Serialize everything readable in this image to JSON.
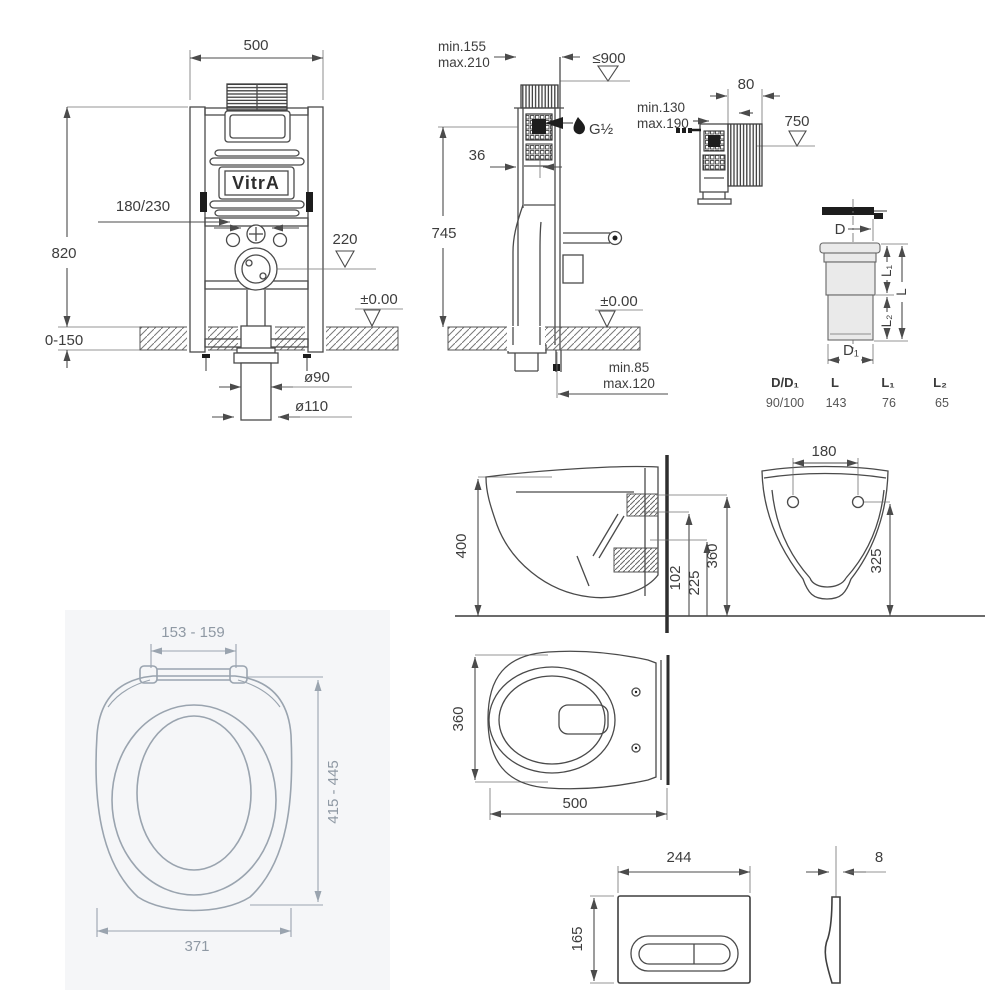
{
  "brand": {
    "logo_text": "VitrA"
  },
  "frame_front": {
    "width": "500",
    "height": "820",
    "floor_adjust": "0-150",
    "flush_pipe": "180/230",
    "drain_depth": "220",
    "datum": "±0.00",
    "dia_90": "ø90",
    "dia_110": "ø110"
  },
  "frame_side": {
    "depth_min": "min.155",
    "depth_max": "max.210",
    "panel_height_max": "≤900",
    "pipe_offset": "36",
    "height": "745",
    "water_connection": "G½",
    "datum": "±0.00",
    "outlet_min": "min.85",
    "outlet_max": "max.120"
  },
  "frame_compact": {
    "tank_depth": "80",
    "supply_min": "min.130",
    "supply_max": "max.190",
    "height": "750"
  },
  "connector": {
    "dim_d": "D",
    "dim_d1": "D₁",
    "dim_l": "L",
    "dim_l1": "L₁",
    "dim_l2": "L₂",
    "table": {
      "headers": [
        "D/D₁",
        "L",
        "L₁",
        "L₂"
      ],
      "row": [
        "90/100",
        "143",
        "76",
        "65"
      ]
    }
  },
  "wc_side": {
    "height": "400",
    "outlet_height": "102",
    "inlet_height": "225"
  },
  "wc_front": {
    "fixing_height": "360",
    "hole_spacing": "180",
    "rim_height": "325"
  },
  "wc_top": {
    "width": "360",
    "depth": "500"
  },
  "seat": {
    "hinge_spacing": "153 - 159",
    "length_range": "415 - 445",
    "width": "371"
  },
  "flush_plate": {
    "width": "244",
    "height": "165",
    "thickness": "8"
  }
}
